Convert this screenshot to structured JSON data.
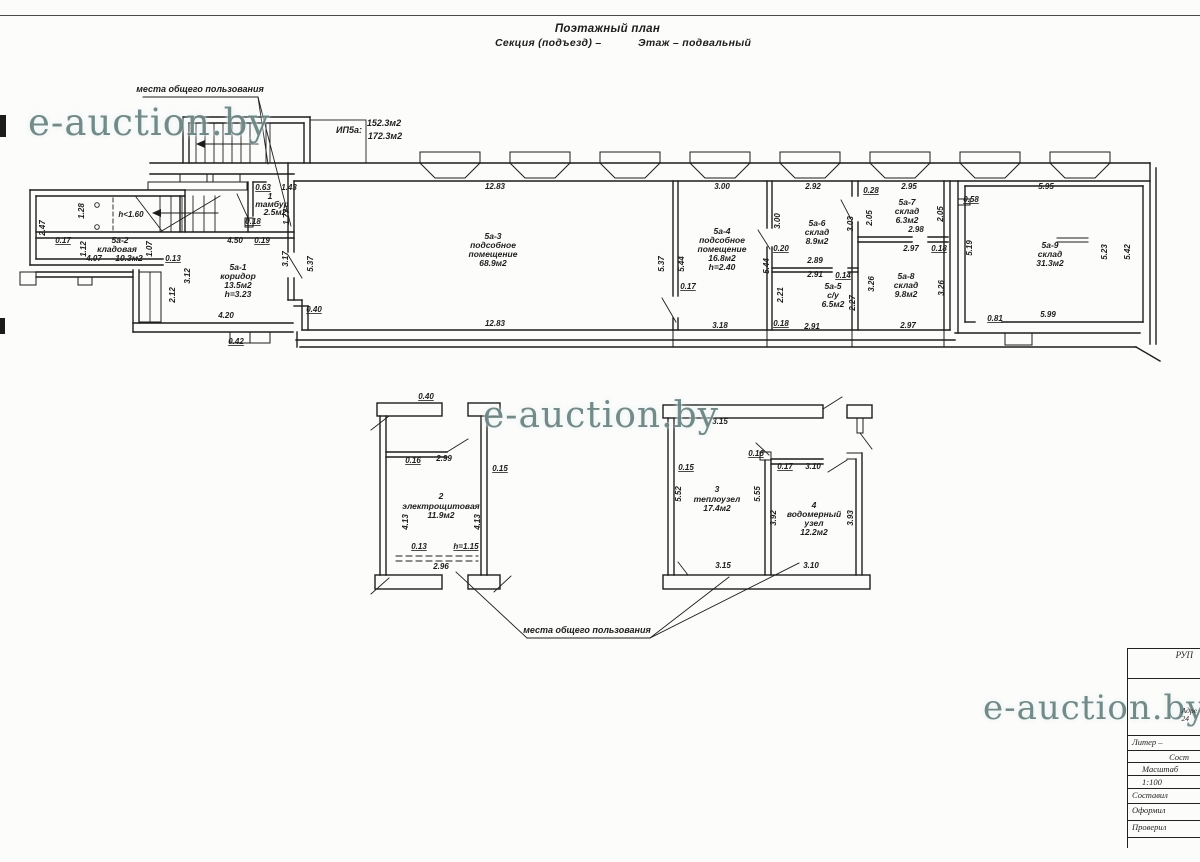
{
  "header": {
    "title": "Поэтажный план",
    "section": "Секция (подъезд) –",
    "floor": "Этаж – подвальный"
  },
  "watermark": {
    "text": "e-auction.by",
    "color": "#587170"
  },
  "titleblock": {
    "org": "РУП",
    "address_line1": "Адре",
    "address_line2": "24",
    "liter": "Литер –",
    "sost": "Сост",
    "scale_label": "Масштаб",
    "scale_value": "1:100",
    "row_sostavil": "Составил",
    "row_oformil": "Оформил",
    "row_proveril": "Проверил"
  },
  "plan_labels": [
    {
      "t": "места общего пользования",
      "x": 200,
      "y": 92,
      "k": "n"
    },
    {
      "t": "ИП5а:",
      "x": 349,
      "y": 133,
      "k": "n"
    },
    {
      "t": "152.3м2",
      "x": 384,
      "y": 126,
      "k": "n"
    },
    {
      "t": "172.3м2",
      "x": 385,
      "y": 139,
      "k": "n"
    },
    {
      "t": "2.47",
      "x": 45,
      "y": 228,
      "r": 1
    },
    {
      "t": "1.28",
      "x": 84,
      "y": 211,
      "r": 1
    },
    {
      "t": "h<1.60",
      "x": 131,
      "y": 217
    },
    {
      "t": "0.17",
      "x": 63,
      "y": 243,
      "u": 1
    },
    {
      "t": "1.12",
      "x": 86,
      "y": 249,
      "r": 1
    },
    {
      "t": "5а-2",
      "x": 120,
      "y": 243,
      "k": "r"
    },
    {
      "t": "кладовая",
      "x": 117,
      "y": 252,
      "k": "r"
    },
    {
      "t": "4.07",
      "x": 94,
      "y": 261
    },
    {
      "t": "10.3м2",
      "x": 129,
      "y": 261,
      "k": "r"
    },
    {
      "t": "1.07",
      "x": 152,
      "y": 249,
      "r": 1
    },
    {
      "t": "0.13",
      "x": 173,
      "y": 261,
      "u": 1
    },
    {
      "t": "3.12",
      "x": 190,
      "y": 276,
      "r": 1
    },
    {
      "t": "2.12",
      "x": 175,
      "y": 295,
      "r": 1
    },
    {
      "t": "5а-1",
      "x": 238,
      "y": 270,
      "k": "r"
    },
    {
      "t": "коридор",
      "x": 238,
      "y": 279,
      "k": "r"
    },
    {
      "t": "13.5м2",
      "x": 238,
      "y": 288,
      "k": "r"
    },
    {
      "t": "h=3.23",
      "x": 238,
      "y": 297,
      "k": "r"
    },
    {
      "t": "4.20",
      "x": 226,
      "y": 318
    },
    {
      "t": "0.42",
      "x": 236,
      "y": 344,
      "u": 1
    },
    {
      "t": "3.17",
      "x": 288,
      "y": 259,
      "r": 1
    },
    {
      "t": "0.63",
      "x": 263,
      "y": 190,
      "u": 1
    },
    {
      "t": "1.43",
      "x": 289,
      "y": 190
    },
    {
      "t": "1",
      "x": 270,
      "y": 199,
      "k": "r"
    },
    {
      "t": "тамбур",
      "x": 272,
      "y": 207,
      "k": "r"
    },
    {
      "t": "2.5м2",
      "x": 275,
      "y": 215,
      "k": "r"
    },
    {
      "t": "0.18",
      "x": 253,
      "y": 224,
      "u": 1
    },
    {
      "t": "1.77",
      "x": 289,
      "y": 217,
      "r": 1
    },
    {
      "t": "4.50",
      "x": 235,
      "y": 243
    },
    {
      "t": "0.19",
      "x": 262,
      "y": 243,
      "u": 1
    },
    {
      "t": "12.83",
      "x": 495,
      "y": 189
    },
    {
      "t": "5.37",
      "x": 313,
      "y": 264,
      "r": 1
    },
    {
      "t": "5а-3",
      "x": 493,
      "y": 239,
      "k": "r"
    },
    {
      "t": "подсобное",
      "x": 493,
      "y": 248,
      "k": "r"
    },
    {
      "t": "помещение",
      "x": 493,
      "y": 257,
      "k": "r"
    },
    {
      "t": "68.9м2",
      "x": 493,
      "y": 266,
      "k": "r"
    },
    {
      "t": "12.83",
      "x": 495,
      "y": 326
    },
    {
      "t": "0.40",
      "x": 314,
      "y": 312,
      "u": 1
    },
    {
      "t": "5.37",
      "x": 664,
      "y": 264,
      "r": 1
    },
    {
      "t": "5.44",
      "x": 684,
      "y": 264,
      "r": 1
    },
    {
      "t": "0.17",
      "x": 688,
      "y": 289,
      "u": 1
    },
    {
      "t": "3.00",
      "x": 722,
      "y": 189
    },
    {
      "t": "5а-4",
      "x": 722,
      "y": 234,
      "k": "r"
    },
    {
      "t": "подсобное",
      "x": 722,
      "y": 243,
      "k": "r"
    },
    {
      "t": "помещение",
      "x": 722,
      "y": 252,
      "k": "r"
    },
    {
      "t": "16.8м2",
      "x": 722,
      "y": 261,
      "k": "r"
    },
    {
      "t": "h=2.40",
      "x": 722,
      "y": 270,
      "k": "r"
    },
    {
      "t": "3.18",
      "x": 720,
      "y": 328
    },
    {
      "t": "5.44",
      "x": 769,
      "y": 266,
      "r": 1
    },
    {
      "t": "3.00",
      "x": 780,
      "y": 221,
      "r": 1
    },
    {
      "t": "2.92",
      "x": 813,
      "y": 189
    },
    {
      "t": "5а-6",
      "x": 817,
      "y": 226,
      "k": "r"
    },
    {
      "t": "склад",
      "x": 817,
      "y": 235,
      "k": "r"
    },
    {
      "t": "8.9м2",
      "x": 817,
      "y": 244,
      "k": "r"
    },
    {
      "t": "0.20",
      "x": 781,
      "y": 251,
      "u": 1
    },
    {
      "t": "2.89",
      "x": 815,
      "y": 263
    },
    {
      "t": "2.91",
      "x": 815,
      "y": 277
    },
    {
      "t": "0.14",
      "x": 843,
      "y": 278,
      "u": 1
    },
    {
      "t": "5а-5",
      "x": 833,
      "y": 289,
      "k": "r"
    },
    {
      "t": "с/у",
      "x": 833,
      "y": 298,
      "k": "r"
    },
    {
      "t": "6.5м2",
      "x": 833,
      "y": 307,
      "k": "r"
    },
    {
      "t": "2.21",
      "x": 783,
      "y": 295,
      "r": 1
    },
    {
      "t": "2.27",
      "x": 855,
      "y": 303,
      "r": 1
    },
    {
      "t": "0.18",
      "x": 781,
      "y": 326,
      "u": 1
    },
    {
      "t": "2.91",
      "x": 812,
      "y": 329
    },
    {
      "t": "3.03",
      "x": 853,
      "y": 224,
      "r": 1
    },
    {
      "t": "3.26",
      "x": 874,
      "y": 284,
      "r": 1
    },
    {
      "t": "2.95",
      "x": 909,
      "y": 189
    },
    {
      "t": "0.28",
      "x": 871,
      "y": 193,
      "u": 1
    },
    {
      "t": "5а-7",
      "x": 907,
      "y": 205,
      "k": "r"
    },
    {
      "t": "склад",
      "x": 907,
      "y": 214,
      "k": "r"
    },
    {
      "t": "6.3м2",
      "x": 907,
      "y": 223,
      "k": "r"
    },
    {
      "t": "2.05",
      "x": 872,
      "y": 218,
      "r": 1
    },
    {
      "t": "2.05",
      "x": 943,
      "y": 214,
      "r": 1
    },
    {
      "t": "2.98",
      "x": 916,
      "y": 232
    },
    {
      "t": "2.97",
      "x": 911,
      "y": 251
    },
    {
      "t": "0.18",
      "x": 939,
      "y": 251,
      "u": 1
    },
    {
      "t": "5а-8",
      "x": 906,
      "y": 279,
      "k": "r"
    },
    {
      "t": "склад",
      "x": 906,
      "y": 288,
      "k": "r"
    },
    {
      "t": "9.8м2",
      "x": 906,
      "y": 297,
      "k": "r"
    },
    {
      "t": "3.26",
      "x": 944,
      "y": 288,
      "r": 1
    },
    {
      "t": "2.97",
      "x": 908,
      "y": 328
    },
    {
      "t": "5.95",
      "x": 1046,
      "y": 189
    },
    {
      "t": "0.58",
      "x": 971,
      "y": 202,
      "u": 1
    },
    {
      "t": "5а-9",
      "x": 1050,
      "y": 248,
      "k": "r"
    },
    {
      "t": "склад",
      "x": 1050,
      "y": 257,
      "k": "r"
    },
    {
      "t": "31.3м2",
      "x": 1050,
      "y": 266,
      "k": "r"
    },
    {
      "t": "5.19",
      "x": 972,
      "y": 248,
      "r": 1
    },
    {
      "t": "5.23",
      "x": 1107,
      "y": 252,
      "r": 1
    },
    {
      "t": "5.42",
      "x": 1130,
      "y": 252,
      "r": 1
    },
    {
      "t": "5.99",
      "x": 1048,
      "y": 317
    },
    {
      "t": "0.81",
      "x": 995,
      "y": 321,
      "u": 1
    },
    {
      "t": "0.40",
      "x": 426,
      "y": 399,
      "u": 1
    },
    {
      "t": "0.16",
      "x": 413,
      "y": 463,
      "u": 1
    },
    {
      "t": "2.99",
      "x": 444,
      "y": 461
    },
    {
      "t": "0.15",
      "x": 500,
      "y": 471,
      "u": 1
    },
    {
      "t": "2",
      "x": 441,
      "y": 499,
      "k": "r"
    },
    {
      "t": "электрощитовая",
      "x": 441,
      "y": 509,
      "k": "r"
    },
    {
      "t": "11.9м2",
      "x": 441,
      "y": 518,
      "k": "r"
    },
    {
      "t": "4.13",
      "x": 408,
      "y": 522,
      "r": 1
    },
    {
      "t": "4.13",
      "x": 480,
      "y": 522,
      "r": 1
    },
    {
      "t": "0.13",
      "x": 419,
      "y": 549,
      "u": 1
    },
    {
      "t": "h=1.15",
      "x": 466,
      "y": 549,
      "u": 1
    },
    {
      "t": "2.96",
      "x": 441,
      "y": 569
    },
    {
      "t": "3.15",
      "x": 720,
      "y": 424
    },
    {
      "t": "0.15",
      "x": 686,
      "y": 470,
      "u": 1
    },
    {
      "t": "0.16",
      "x": 756,
      "y": 456,
      "u": 1
    },
    {
      "t": "0.17",
      "x": 785,
      "y": 469,
      "u": 1
    },
    {
      "t": "3.10",
      "x": 813,
      "y": 469
    },
    {
      "t": "3",
      "x": 717,
      "y": 492,
      "k": "r"
    },
    {
      "t": "теплоузел",
      "x": 717,
      "y": 502,
      "k": "r"
    },
    {
      "t": "17.4м2",
      "x": 717,
      "y": 511,
      "k": "r"
    },
    {
      "t": "5.52",
      "x": 681,
      "y": 494,
      "r": 1
    },
    {
      "t": "5.55",
      "x": 760,
      "y": 494,
      "r": 1
    },
    {
      "t": "4",
      "x": 814,
      "y": 508,
      "k": "r"
    },
    {
      "t": "водомерный",
      "x": 814,
      "y": 517,
      "k": "r"
    },
    {
      "t": "узел",
      "x": 814,
      "y": 526,
      "k": "r"
    },
    {
      "t": "12.2м2",
      "x": 814,
      "y": 535,
      "k": "r"
    },
    {
      "t": "3.92",
      "x": 776,
      "y": 518,
      "r": 1
    },
    {
      "t": "3.93",
      "x": 853,
      "y": 518,
      "r": 1
    },
    {
      "t": "3.15",
      "x": 723,
      "y": 568
    },
    {
      "t": "3.10",
      "x": 811,
      "y": 568
    },
    {
      "t": "места общего пользования",
      "x": 587,
      "y": 633,
      "k": "n"
    }
  ]
}
